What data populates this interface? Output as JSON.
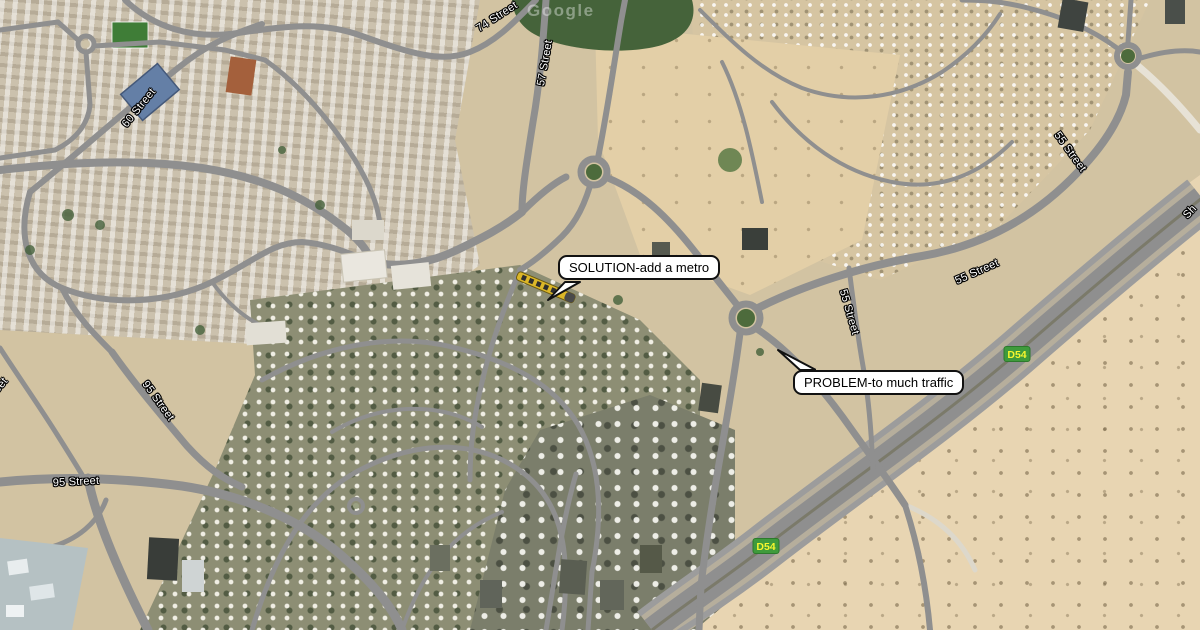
{
  "map": {
    "watermark": "Google",
    "colors": {
      "route_shield_bg": "#3f9b3c",
      "route_shield_text": "#f6f62e",
      "callout_bg": "#ffffff",
      "callout_border": "#111111",
      "street_label_text": "#ffffff",
      "street_label_halo": "#000000"
    },
    "street_labels": [
      {
        "text": "74 Street",
        "x": 497,
        "y": 17,
        "rot": -33
      },
      {
        "text": "57 Street",
        "x": 545,
        "y": 63,
        "rot": -80
      },
      {
        "text": "60 Street",
        "x": 139,
        "y": 108,
        "rot": -51
      },
      {
        "text": "55 Street",
        "x": 1070,
        "y": 152,
        "rot": 54
      },
      {
        "text": "55 Street",
        "x": 849,
        "y": 312,
        "rot": 74
      },
      {
        "text": "55 Street",
        "x": 977,
        "y": 272,
        "rot": -24
      },
      {
        "text": "95 Street",
        "x": 158,
        "y": 401,
        "rot": 54
      },
      {
        "text": "95 Street",
        "x": 76,
        "y": 482,
        "rot": -3
      },
      {
        "text": "Street",
        "x": -4,
        "y": 391,
        "rot": -50
      },
      {
        "text": "Sh",
        "x": 1190,
        "y": 212,
        "rot": -47
      }
    ],
    "route_shields": [
      {
        "text": "D54",
        "x": 1017,
        "y": 354
      },
      {
        "text": "D54",
        "x": 766,
        "y": 546
      }
    ],
    "callouts": [
      {
        "text": "SOLUTION-add a metro"
      },
      {
        "text": "PROBLEM-to much traffic"
      }
    ]
  }
}
